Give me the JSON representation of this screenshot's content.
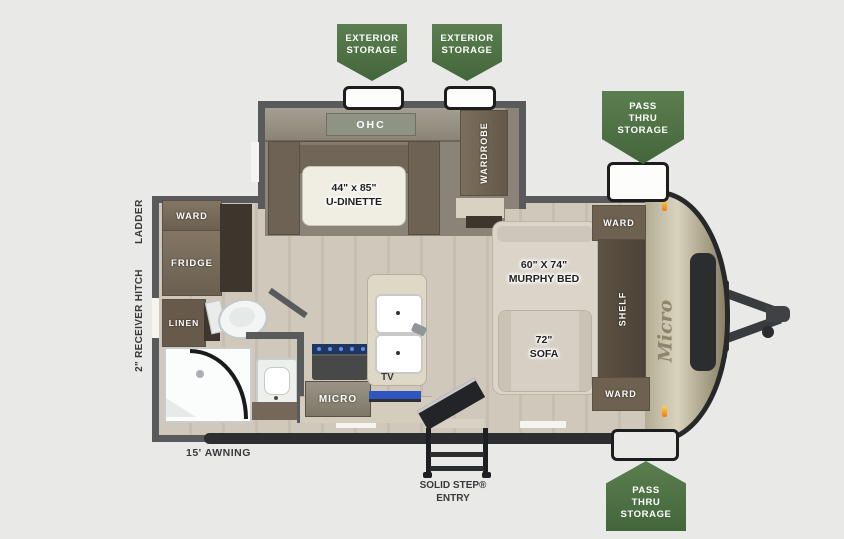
{
  "badges": {
    "exterior_storage_1": "EXTERIOR\nSTORAGE",
    "exterior_storage_2": "EXTERIOR\nSTORAGE",
    "pass_thru_top": "PASS\nTHRU\nSTORAGE",
    "pass_thru_bottom": "PASS\nTHRU\nSTORAGE"
  },
  "exterior": {
    "ladder": "LADDER",
    "receiver_hitch": "2\" RECEIVER HITCH",
    "awning": "15' AWNING",
    "entry": "SOLID STEP®\nENTRY"
  },
  "interior": {
    "ohc": "OHC",
    "u_dinette": "44\" x 85\"\nU-DINETTE",
    "wardrobe": "WARDROBE",
    "ward_rear": "WARD",
    "fridge": "FRIDGE",
    "linen": "LINEN",
    "micro": "MICRO",
    "tv": "TV",
    "murphy_bed": "60\" X 74\"\nMURPHY BED",
    "sofa": "72\"\nSOFA",
    "ward_front_top": "WARD",
    "shelf": "SHELF",
    "ward_front_bottom": "WARD"
  },
  "brand": {
    "logo": "Micro"
  },
  "colors": {
    "badge_green": "#4c7043",
    "wall_gray": "#595a5c",
    "floor_wood": "#cbc4b7",
    "carpet": "#8b8377",
    "cabinet_brown": "#7b6e5d",
    "front_cap_beige": "#cfc9b4",
    "accent_blue": "#2f55c0",
    "marker_orange": "#f07818",
    "background": "#e9eae8"
  }
}
